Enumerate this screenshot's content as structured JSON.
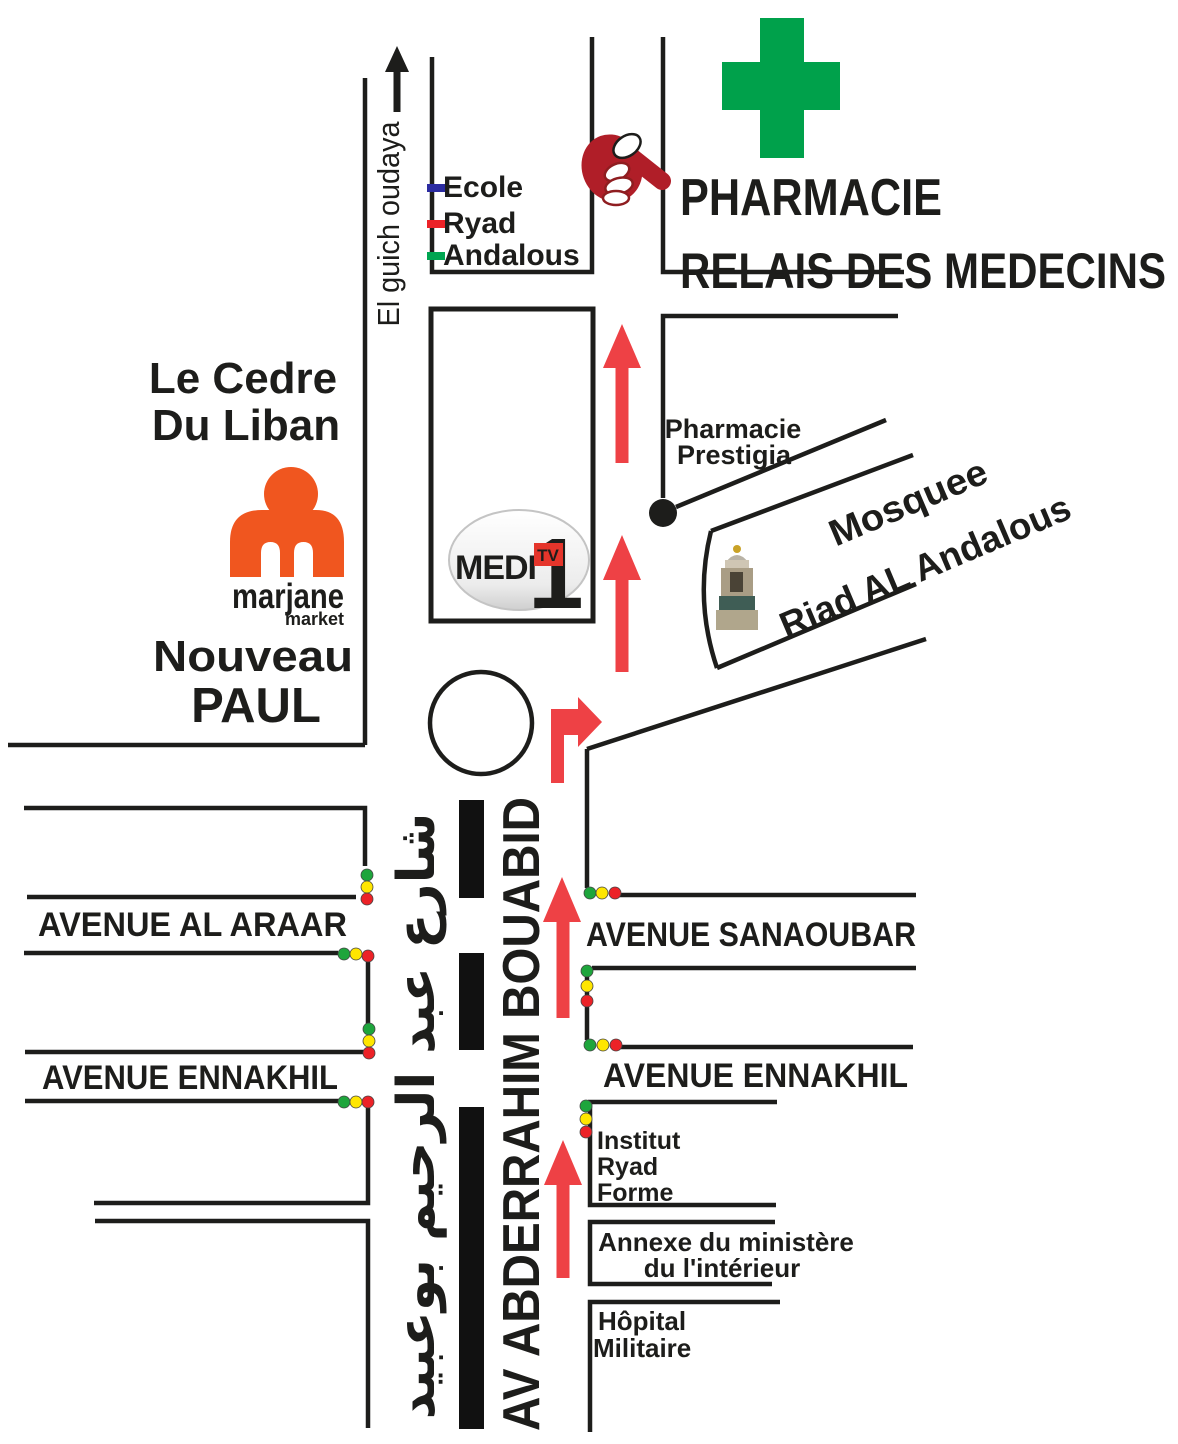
{
  "map": {
    "pharmacy": {
      "title_line1": "PHARMACIE",
      "title_line2": "RELAIS DES MEDECINS"
    },
    "legend": {
      "items": [
        {
          "label": "Ecole",
          "color": "#2B2BA0"
        },
        {
          "label": "Ryad",
          "color": "#EC2227"
        },
        {
          "label": "Andalous",
          "color": "#00A551"
        }
      ]
    },
    "north_street": "El guich oudaya",
    "places": {
      "le_cedre_line1": "Le Cedre",
      "le_cedre_line2": "Du Liban",
      "nouveau_line1": "Nouveau",
      "nouveau_line2": "PAUL",
      "marjane_name": "marjane",
      "marjane_sub": "market",
      "medi_text": "MEDI",
      "medi_one": "1",
      "medi_tv": "TV",
      "prestigia_line1": "Pharmacie",
      "prestigia_line2": "Prestigia",
      "mosque_line1": "Mosquee",
      "mosque_line2": "Riad AL Andalous",
      "institut_line1": "Institut",
      "institut_line2": "Ryad",
      "institut_line3": "Forme",
      "annexe_line1": "Annexe du ministère",
      "annexe_line2": "du l'intérieur",
      "hopital_line1": "Hôpital",
      "hopital_line2": "Militaire"
    },
    "streets": {
      "avenue_al_araar": "AVENUE AL ARAAR",
      "avenue_ennakhil_left": "AVENUE ENNAKHIL",
      "avenue_sanaoubar": "AVENUE SANAOUBAR",
      "avenue_ennakhil_right": "AVENUE ENNAKHIL",
      "main_avenue": "AV ABDERRAHIM BOUABID",
      "main_avenue_arabic": "شارع عبد الرحيم بوعبيد"
    },
    "colors": {
      "pharmacy_cross": "#00A14B",
      "hand": "#B01E28",
      "route_arrow": "#EE4145",
      "marjane_orange": "#F0561F",
      "medi_red": "#E5352B",
      "traffic_green": "#1EA53C",
      "traffic_yellow": "#FFE600",
      "traffic_red": "#EC2227",
      "road": "#1D1D1B"
    }
  }
}
